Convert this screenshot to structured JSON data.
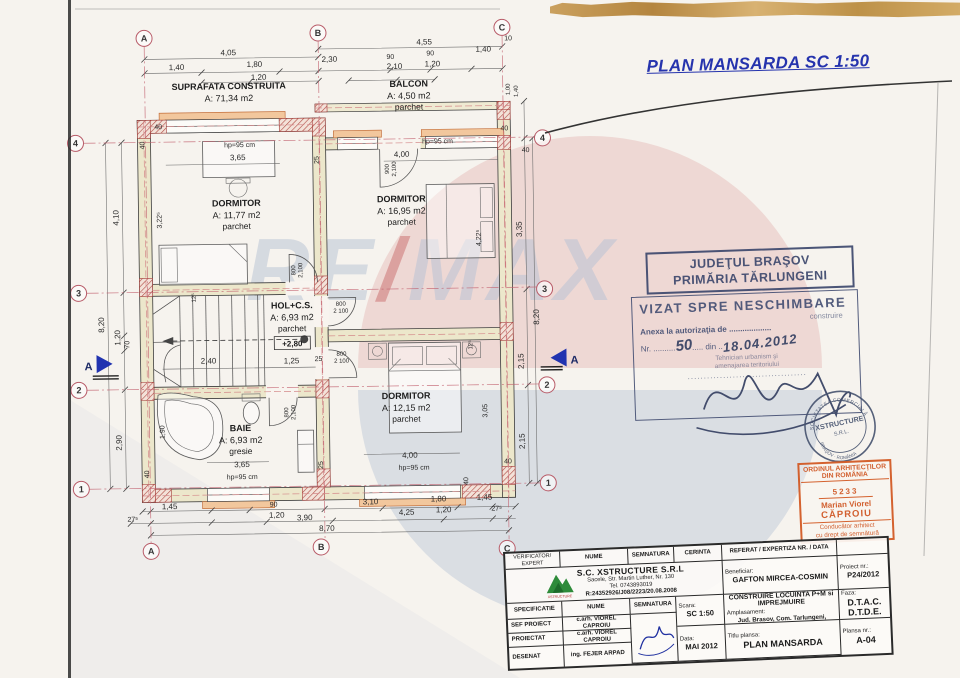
{
  "title": "PLAN MANSARDA SC 1:50",
  "watermark": {
    "part1": "RE",
    "slash": "/",
    "part2": "MAX"
  },
  "plan": {
    "section_marker": "A",
    "rooms": [
      {
        "name": "SUPRAFATA CONSTRUITA",
        "area": "A: 71,34 m2",
        "x": 232,
        "y": 88
      },
      {
        "name": "BALCON",
        "area": "A: 4,50 m2",
        "finish": "parchet",
        "x": 412,
        "y": 88
      },
      {
        "name": "DORMITOR",
        "area": "A: 11,77 m2",
        "finish": "parchet",
        "x": 238,
        "y": 205
      },
      {
        "name": "DORMITOR",
        "area": "A: 16,95 m2",
        "finish": "parchet",
        "x": 403,
        "y": 203
      },
      {
        "name": "HOL+C.S.",
        "area": "A: 6,93 m2",
        "finish": "parchet",
        "level": "+2,80",
        "x": 292,
        "y": 308
      },
      {
        "name": "DORMITOR",
        "area": "A: 12,15 m2",
        "finish": "parchet",
        "x": 405,
        "y": 400
      },
      {
        "name": "BAIE",
        "area": "A: 6,93 m2",
        "finish": "gresie",
        "x": 239,
        "y": 430
      }
    ],
    "axis_bubbles": [
      {
        "l": "A",
        "x": 148,
        "y": 36
      },
      {
        "l": "B",
        "x": 322,
        "y": 33
      },
      {
        "l": "C",
        "x": 506,
        "y": 30
      },
      {
        "l": "A",
        "x": 148,
        "y": 549
      },
      {
        "l": "B",
        "x": 318,
        "y": 547
      },
      {
        "l": "C",
        "x": 504,
        "y": 551
      },
      {
        "l": "4",
        "x": 78,
        "y": 140
      },
      {
        "l": "3",
        "x": 79,
        "y": 290
      },
      {
        "l": "2",
        "x": 78,
        "y": 387
      },
      {
        "l": "1",
        "x": 79,
        "y": 486
      },
      {
        "l": "4",
        "x": 545,
        "y": 141
      },
      {
        "l": "3",
        "x": 545,
        "y": 292
      },
      {
        "l": "2",
        "x": 546,
        "y": 388
      },
      {
        "l": "1",
        "x": 546,
        "y": 486
      }
    ],
    "dim_labels": [
      {
        "t": "4,05",
        "x": 232,
        "y": 54
      },
      {
        "t": "4,55",
        "x": 428,
        "y": 46
      },
      {
        "t": "10",
        "x": 512,
        "y": 43,
        "s": 7
      },
      {
        "t": "1,40",
        "x": 180,
        "y": 68
      },
      {
        "t": "1,80",
        "x": 258,
        "y": 66
      },
      {
        "t": "2,30",
        "x": 333,
        "y": 62
      },
      {
        "t": "90",
        "x": 394,
        "y": 60,
        "s": 7
      },
      {
        "t": "90",
        "x": 434,
        "y": 57,
        "s": 7
      },
      {
        "t": "1,40",
        "x": 487,
        "y": 54
      },
      {
        "t": "1,20",
        "x": 262,
        "y": 79
      },
      {
        "t": "2,10",
        "x": 398,
        "y": 70
      },
      {
        "t": "1,20",
        "x": 436,
        "y": 68
      },
      {
        "t": "4,10",
        "x": 120,
        "y": 215,
        "r": -90
      },
      {
        "t": "8,20",
        "x": 104,
        "y": 322,
        "r": -90
      },
      {
        "t": "1,20",
        "x": 120,
        "y": 335,
        "r": -90
      },
      {
        "t": "70",
        "x": 129,
        "y": 342,
        "r": -90,
        "s": 7
      },
      {
        "t": "2,90",
        "x": 120,
        "y": 440,
        "r": -90
      },
      {
        "t": "3,22⁵",
        "x": 163,
        "y": 218,
        "r": -90,
        "s": 7
      },
      {
        "t": "1,90",
        "x": 163,
        "y": 430,
        "r": -90,
        "s": 7
      },
      {
        "t": "3,35",
        "x": 523,
        "y": 232,
        "r": -90
      },
      {
        "t": "8,20",
        "x": 539,
        "y": 320,
        "r": -90
      },
      {
        "t": "2,15",
        "x": 523,
        "y": 364,
        "r": -90
      },
      {
        "t": "2,15",
        "x": 523,
        "y": 444,
        "r": -90
      },
      {
        "t": "4,22⁵",
        "x": 482,
        "y": 240,
        "r": -90,
        "s": 7
      },
      {
        "t": "12⁵",
        "x": 472,
        "y": 347,
        "r": -90,
        "s": 6
      },
      {
        "t": "3,05",
        "x": 486,
        "y": 413,
        "r": -90,
        "s": 7
      },
      {
        "t": "1,45",
        "x": 167,
        "y": 507
      },
      {
        "t": "90",
        "x": 271,
        "y": 506,
        "s": 7
      },
      {
        "t": "3,10",
        "x": 368,
        "y": 505
      },
      {
        "t": "1,80",
        "x": 436,
        "y": 503
      },
      {
        "t": "1,45",
        "x": 482,
        "y": 502
      },
      {
        "t": "27⁵",
        "x": 130,
        "y": 519,
        "s": 7
      },
      {
        "t": "1,20",
        "x": 274,
        "y": 517
      },
      {
        "t": "3,90",
        "x": 302,
        "y": 520
      },
      {
        "t": "4,25",
        "x": 404,
        "y": 516
      },
      {
        "t": "1,20",
        "x": 441,
        "y": 514
      },
      {
        "t": "27⁵",
        "x": 494,
        "y": 513,
        "s": 7
      },
      {
        "t": "8,70",
        "x": 324,
        "y": 531
      },
      {
        "t": "hp=95 cm",
        "x": 242,
        "y": 146,
        "s": 7
      },
      {
        "t": "3,65",
        "x": 240,
        "y": 159
      },
      {
        "t": "hp=95 cm",
        "x": 440,
        "y": 145,
        "s": 7
      },
      {
        "t": "4,00",
        "x": 404,
        "y": 158
      },
      {
        "t": "3,65",
        "x": 240,
        "y": 466
      },
      {
        "t": "hp=95 cm",
        "x": 240,
        "y": 478,
        "s": 7
      },
      {
        "t": "4,00",
        "x": 408,
        "y": 459
      },
      {
        "t": "hp=95 cm",
        "x": 412,
        "y": 471,
        "s": 7
      },
      {
        "t": "2,40",
        "x": 208,
        "y": 362
      },
      {
        "t": "1,25",
        "x": 291,
        "y": 363
      },
      {
        "t": "25",
        "x": 318,
        "y": 361,
        "s": 7
      },
      {
        "t": "900",
        "x": 391,
        "y": 170,
        "r": -90,
        "s": 6
      },
      {
        "t": "2,100",
        "x": 398,
        "y": 170,
        "r": -90,
        "s": 6
      },
      {
        "t": "800",
        "x": 296,
        "y": 270,
        "r": -90,
        "s": 6
      },
      {
        "t": "2,100",
        "x": 303,
        "y": 270,
        "r": -90,
        "s": 6
      },
      {
        "t": "800",
        "x": 341,
        "y": 306,
        "s": 6
      },
      {
        "t": "2 100",
        "x": 341,
        "y": 313,
        "s": 6
      },
      {
        "t": "800",
        "x": 341,
        "y": 356,
        "s": 6
      },
      {
        "t": "2 100",
        "x": 341,
        "y": 363,
        "s": 6
      },
      {
        "t": "800",
        "x": 287,
        "y": 412,
        "r": -90,
        "s": 6
      },
      {
        "t": "2,100",
        "x": 294,
        "y": 412,
        "r": -90,
        "s": 6
      },
      {
        "t": "40",
        "x": 147,
        "y": 143,
        "r": -90,
        "s": 7
      },
      {
        "t": "40",
        "x": 161,
        "y": 127,
        "s": 7
      },
      {
        "t": "25",
        "x": 321,
        "y": 160,
        "r": -90,
        "s": 7
      },
      {
        "t": "40",
        "x": 507,
        "y": 133,
        "s": 7
      },
      {
        "t": "40",
        "x": 528,
        "y": 155,
        "s": 7
      },
      {
        "t": "40",
        "x": 147,
        "y": 472,
        "r": -90,
        "s": 7
      },
      {
        "t": "25",
        "x": 321,
        "y": 465,
        "r": -90,
        "s": 7
      },
      {
        "t": "40",
        "x": 506,
        "y": 466,
        "s": 7
      },
      {
        "t": "40",
        "x": 466,
        "y": 483,
        "r": -90,
        "s": 7
      },
      {
        "t": "12⁵",
        "x": 196,
        "y": 296,
        "r": -90,
        "s": 6
      },
      {
        "t": "1,00",
        "x": 513,
        "y": 92,
        "r": -90,
        "s": 6
      },
      {
        "t": "1,40",
        "x": 521,
        "y": 94,
        "r": -90,
        "s": 6
      }
    ]
  },
  "stamps": {
    "primaria": {
      "line1": "JUDEŢUL BRAŞOV",
      "line2": "PRIMĂRIA TĂRLUNGENI"
    },
    "vizat": {
      "heading": "VIZAT SPRE NESCHIMBARE",
      "option1": "construire",
      "option2": "desfiinţare",
      "anexa": "Anexa la autorizaţia de ...................",
      "nr_label": "Nr.",
      "nr_value": "50",
      "din_label": "din",
      "date_value": "18.04.2012",
      "footer1": "Tehnician urbanism şi",
      "footer2": "amenajarea teritoriului",
      "dots": "....................................."
    },
    "round": {
      "top": "SOCIETATEA COMERCIALĂ",
      "name": "XSTRUCTURE",
      "srl": "S.R.L.",
      "bottom": "BRAŞOV · ROMÂNIA"
    },
    "oar": {
      "line1": "ORDINUL ARHITECŢILOR",
      "line2": "DIN ROMÂNIA",
      "number": "5233",
      "name1": "Marian Viorel",
      "name2": "CĂPROIU",
      "title1": "Conducător arhitect",
      "title2": "cu drept de semnătură"
    }
  },
  "title_block": {
    "verificator": "VERIFICATOR/",
    "expert": "EXPERT",
    "nume": "NUME",
    "semnatura": "SEMNATURA",
    "cerinta": "CERINTA",
    "referat": "REFERAT / EXPERTIZA NR. / DATA",
    "firm_name": "S.C. XSTRUCTURE S.R.L",
    "firm_addr": "Sacele, Str. Martin Luther, Nr. 130",
    "firm_tel": "Tel. 0743893019",
    "firm_reg": "R:24352926/J08/2223/20.08.2008",
    "specificatie": "SPECIFICATIE",
    "sef_proiect": "SEF PROIECT",
    "proiectat": "PROIECTAT",
    "desenat": "DESENAT",
    "name_sef": "c.arh. VIOREL CAPROIU",
    "name_proiectat": "c.arh. VIOREL CAPROIU",
    "name_desenat": "ing. FEJER ARPAD",
    "scara_label": "Scara:",
    "scara": "SC 1:50",
    "data_label": "Data:",
    "data": "MAI 2012",
    "beneficiar_label": "Beneficiar:",
    "beneficiar": "GAFTON MIRCEA-COSMIN",
    "proiect_nr_label": "Proiect nr.:",
    "proiect_nr": "P24/2012",
    "titlu_proiect_label": "Titlu proiect:",
    "titlu_proiect": "CONSTRUIRE LOCUINTA P+M si IMPREJMUIRE",
    "amplasament_label": "Amplasament:",
    "amplasament1": "Jud. Brasov, Com. Tarlungeni,",
    "amplasament2": "Str. Salcamilor",
    "faza_label": "Faza:",
    "faza1": "D.T.A.C.",
    "faza2": "D.T.D.E.",
    "titlu_plansa_label": "Titlu plansa:",
    "titlu_plansa": "PLAN MANSARDA",
    "plansa_nr_label": "Plansa nr.:",
    "plansa_nr": "A-04"
  }
}
